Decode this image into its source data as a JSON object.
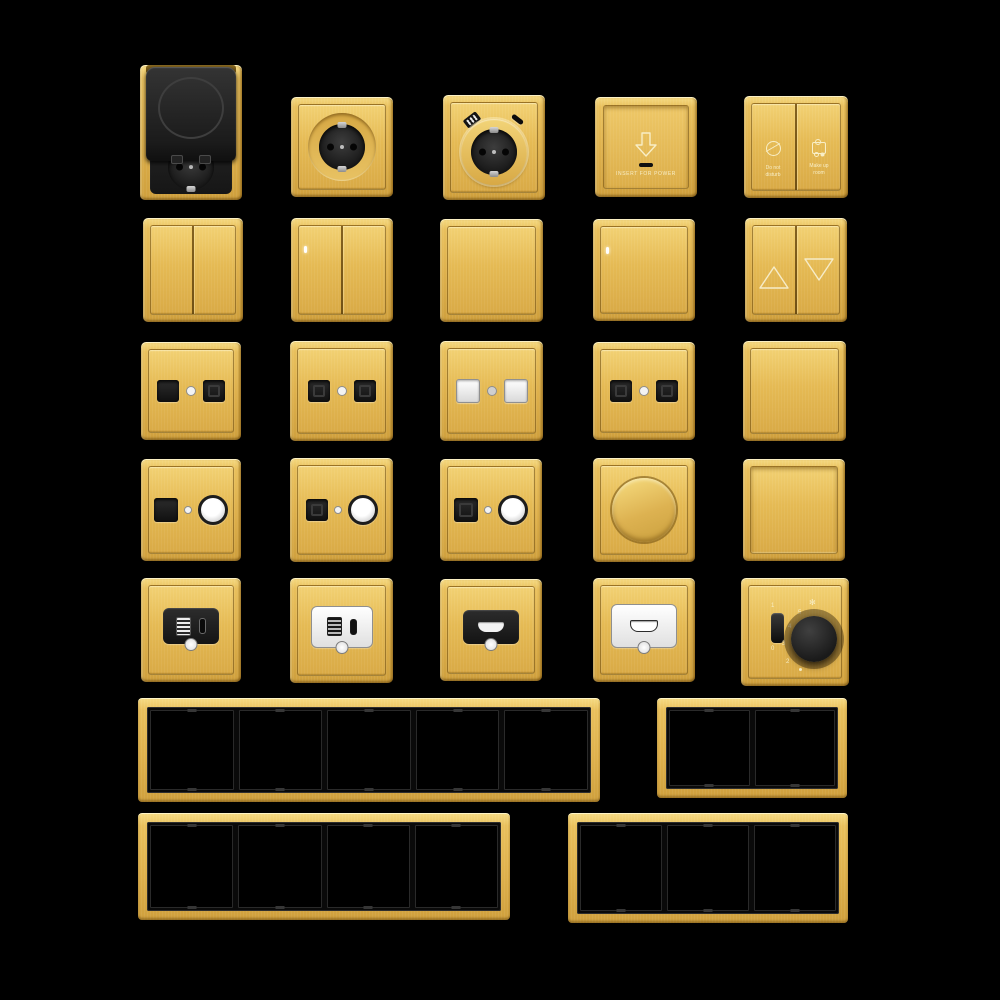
{
  "palette": {
    "background": "#000000",
    "gold": "#e9c05c",
    "gold_light": "#f6db84",
    "gold_dark": "#aa8026",
    "module_black": "#1d1d1d",
    "module_white": "#f4f4f4",
    "text_cream": "#f8eec6"
  },
  "card_holder": {
    "label": "INSERT FOR POWER"
  },
  "service_switch": {
    "left": {
      "line1": "Do not",
      "line2": "disturb"
    },
    "right": {
      "line1": "Make up",
      "line2": "room"
    }
  },
  "fan_controller": {
    "toggle_top": "1",
    "toggle_bottom": "0",
    "marks": [
      "5",
      "4",
      "3",
      "2"
    ],
    "fan_icon": "✻"
  },
  "frames": [
    {
      "gangs": 5
    },
    {
      "gangs": 2
    },
    {
      "gangs": 4
    },
    {
      "gangs": 3
    }
  ]
}
